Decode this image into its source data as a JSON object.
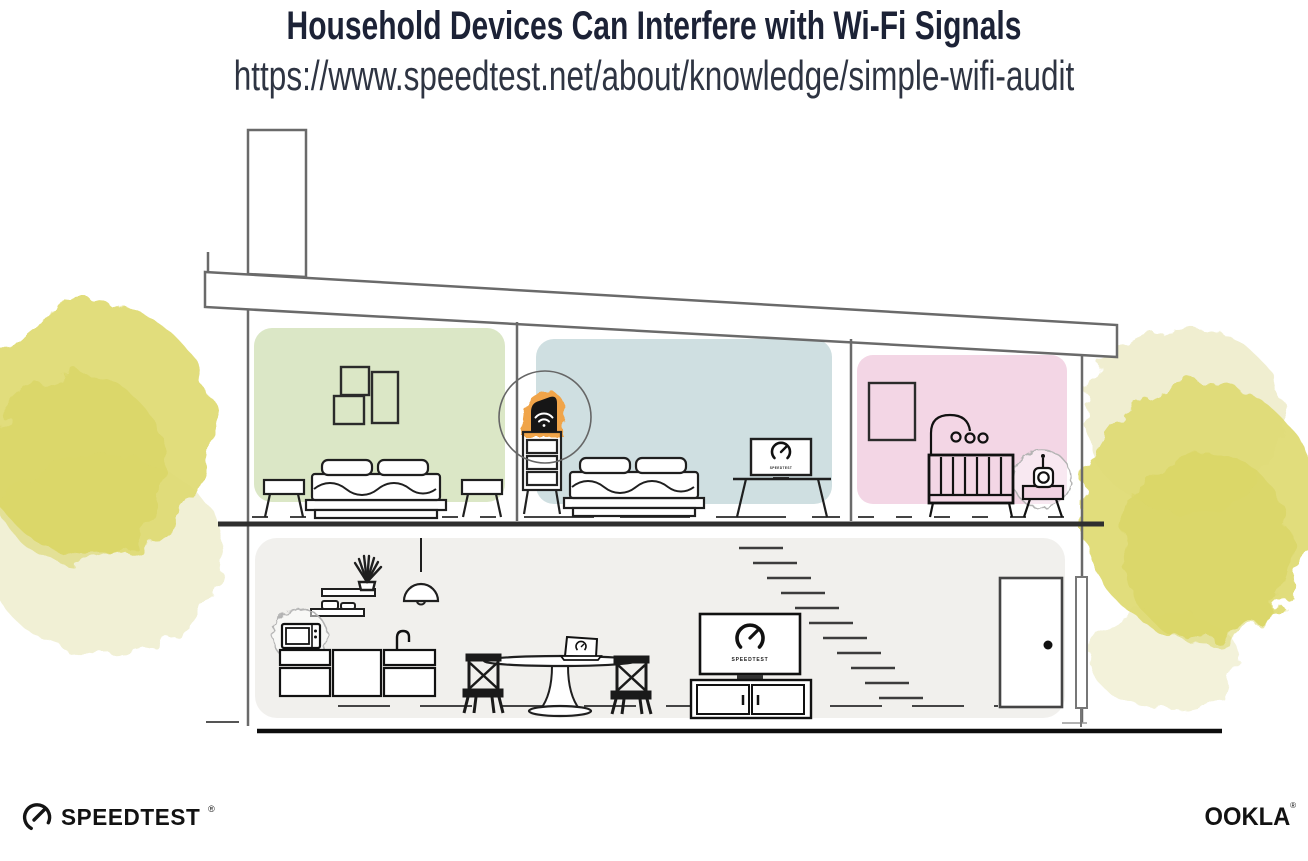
{
  "header": {
    "title": "Household Devices Can Interfere with Wi-Fi Signals",
    "url": "https://www.speedtest.net/about/knowledge/simple-wifi-audit"
  },
  "branding": {
    "speedtest_wordmark": "SPEEDTEST",
    "speedtest_reg_mark": "®",
    "ookla_wordmark": "OOKLA",
    "ookla_reg_mark": "®"
  },
  "illustration": {
    "tv_screen_label": "SPEEDTEST",
    "desk_monitor_label": "SPEEDTEST"
  },
  "colors": {
    "title_ink": "#1c2236",
    "green_room": "#dbe7c6",
    "blue_room": "#cfdfe1",
    "pink_room": "#f3d6e5",
    "lower_floor": "#f1f0ed",
    "foliage_yellow": "#deda72",
    "foliage_light": "#eeeccb",
    "foliage_deep": "#d5d157",
    "router_highlight": "#f0a449",
    "structure_line": "#6a6a6a",
    "furniture_ink": "#1f1f1f"
  }
}
